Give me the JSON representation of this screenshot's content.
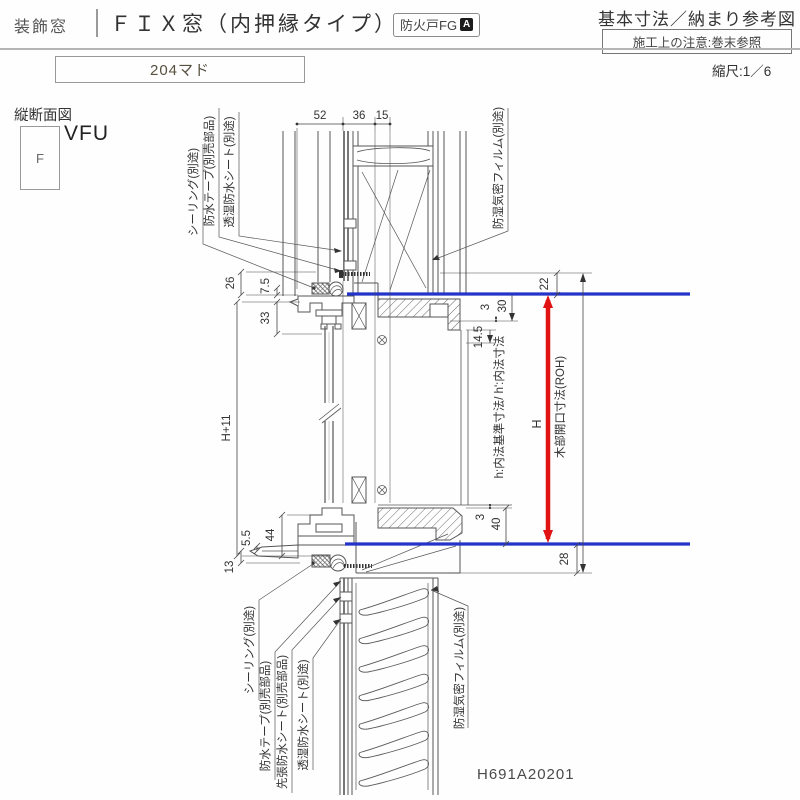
{
  "header": {
    "category": "装飾窓",
    "title": "ＦＩＸ窓（内押縁タイプ）",
    "fire_badge": "防火戸FG",
    "fire_badge_mark": "A",
    "spec_title": "基本寸法／納まり参考図",
    "note": "施工上の注意:巻末参照",
    "size_label": "204マド",
    "scale": "縮尺:1／6"
  },
  "section": {
    "view_label": "縦断面図",
    "frame_type": "F",
    "product_code": "VFU",
    "drawing_number": "H691A20201"
  },
  "dimensions": {
    "top": [
      "52",
      "36",
      "15"
    ],
    "d26": "26",
    "d75": "7.5",
    "d33": "33",
    "h11": "H+11",
    "d44": "44",
    "d55": "5.5",
    "d13": "13",
    "d3_head": "3",
    "d30": "30",
    "d145": "14.5",
    "d22": "22",
    "d3_sill": "3",
    "d40": "40",
    "d28": "28",
    "opening_height": "H",
    "inner_label": "h:内法基準寸法/ h':内法寸法",
    "roh_label": "木部開口寸法(ROH)"
  },
  "annotations": {
    "top_left": [
      "シーリング(別途)",
      "防水テープ(別売部品)",
      "透湿防水シート(別途)"
    ],
    "top_right": "防湿気密フィルム(別途)",
    "bottom_left": [
      "シーリング(別途)",
      "防水テープ(別売部品)",
      "先張防水シート(別売部品)",
      "透湿防水シート(別途)"
    ],
    "bottom_right": "防湿気密フィルム(別途)"
  },
  "colors": {
    "reference_blue": "#2335c8",
    "dimension_red": "#e01212"
  }
}
